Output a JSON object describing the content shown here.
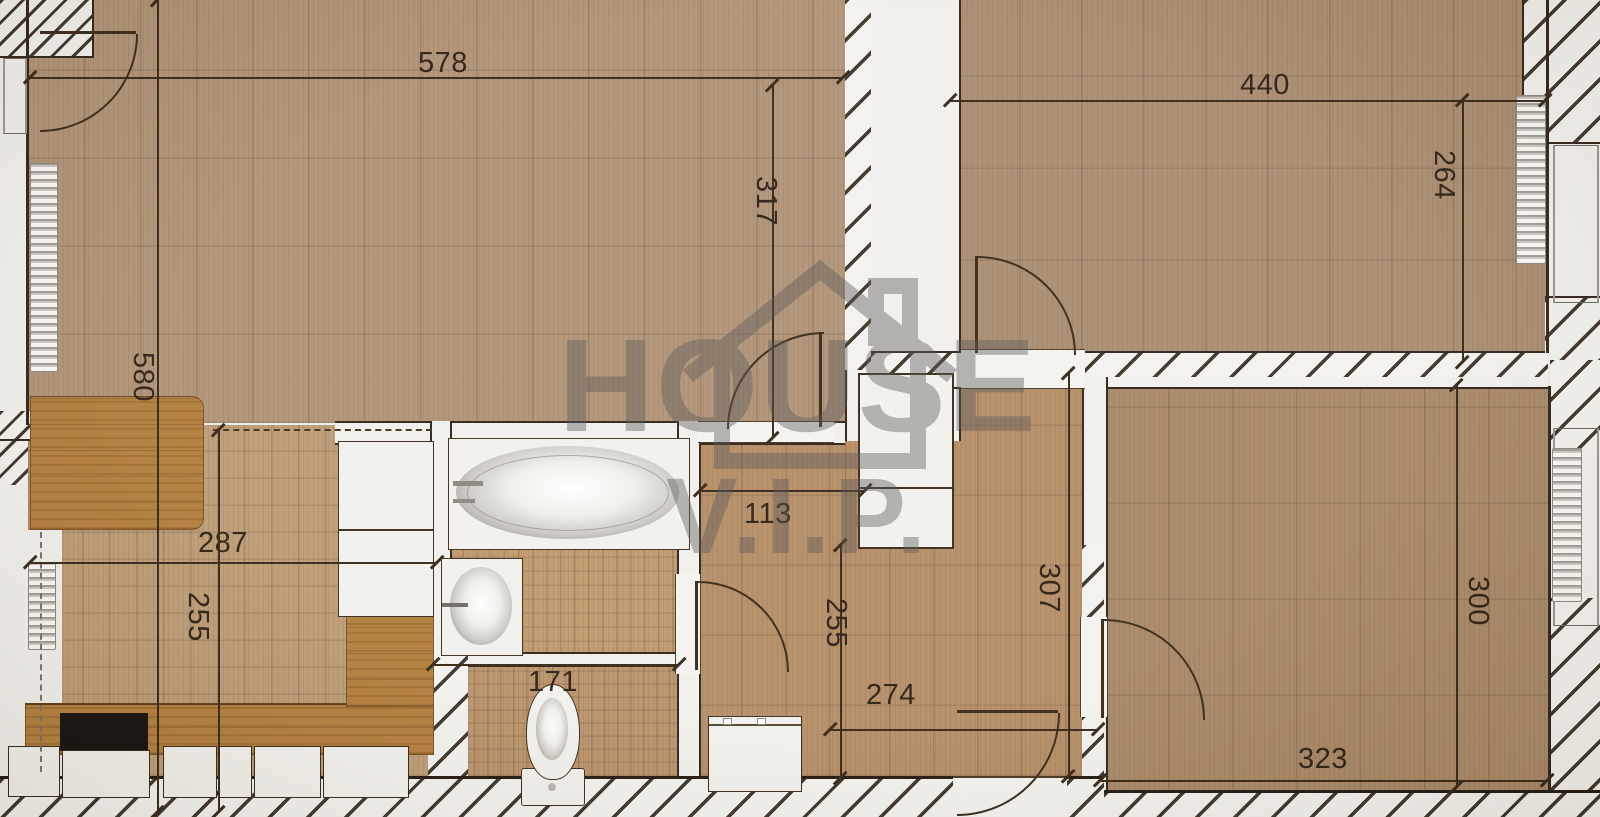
{
  "watermark": {
    "title": "HOUSE",
    "subtitle": "V.I.P."
  },
  "dimensions": [
    {
      "name": "dim-578",
      "value": "578",
      "orient": "h",
      "x": 30,
      "y": 77,
      "len": 813,
      "lx": 418,
      "ly": 49
    },
    {
      "name": "dim-580",
      "value": "580",
      "orient": "v",
      "x": 157,
      "y": 0,
      "len": 812,
      "lx": 157,
      "ly": 352
    },
    {
      "name": "dim-317",
      "value": "317",
      "orient": "v",
      "x": 772,
      "y": 85,
      "len": 353,
      "lx": 780,
      "ly": 176
    },
    {
      "name": "dim-440",
      "value": "440",
      "orient": "h",
      "x": 950,
      "y": 100,
      "len": 595,
      "lx": 1240,
      "ly": 71
    },
    {
      "name": "dim-264",
      "value": "264",
      "orient": "v",
      "x": 1462,
      "y": 100,
      "len": 262,
      "lx": 1458,
      "ly": 150
    },
    {
      "name": "dim-287",
      "value": "287",
      "orient": "h",
      "x": 30,
      "y": 562,
      "len": 407,
      "lx": 198,
      "ly": 529
    },
    {
      "name": "dim-255-left",
      "value": "255",
      "orient": "v",
      "x": 218,
      "y": 430,
      "len": 382,
      "lx": 212,
      "ly": 592
    },
    {
      "name": "dim-113",
      "value": "113",
      "orient": "h",
      "x": 700,
      "y": 490,
      "len": 165,
      "lx": 744,
      "ly": 500
    },
    {
      "name": "dim-255-hall",
      "value": "255",
      "orient": "v",
      "x": 840,
      "y": 545,
      "len": 233,
      "lx": 850,
      "ly": 598
    },
    {
      "name": "dim-307",
      "value": "307",
      "orient": "v",
      "x": 1068,
      "y": 373,
      "len": 403,
      "lx": 1063,
      "ly": 563
    },
    {
      "name": "dim-274",
      "value": "274",
      "orient": "h",
      "x": 830,
      "y": 729,
      "len": 268,
      "lx": 866,
      "ly": 681
    },
    {
      "name": "dim-171",
      "value": "171",
      "orient": "h",
      "x": 433,
      "y": 664,
      "len": 246,
      "lx": 528,
      "ly": 668
    },
    {
      "name": "dim-300",
      "value": "300",
      "orient": "v",
      "x": 1456,
      "y": 385,
      "len": 402,
      "lx": 1492,
      "ly": 576
    },
    {
      "name": "dim-323",
      "value": "323",
      "orient": "h",
      "x": 1100,
      "y": 780,
      "len": 447,
      "lx": 1298,
      "ly": 745
    }
  ],
  "palette": {
    "wall_line": "#32241a",
    "dim_text": "#2e2115",
    "wood_living": "#b19478",
    "wood_bedroom_top": "#ab8e72",
    "wood_hallway": "#b68f68",
    "wood_bedroom_bottom": "#a98969",
    "wood_kitchen": "#bd9d77",
    "wood_bath": "#c29a6e",
    "counter_wood": "#b27f3e",
    "wall_fill": "#f1f0ec",
    "cooktop": "#161210",
    "watermark_gray": "#555555"
  },
  "fixtures": [
    "bathtub",
    "sink",
    "toilet",
    "washing-machine",
    "wardrobe",
    "closet",
    "kitchen-counter",
    "cooktop",
    "kitchen-cabinets",
    "table",
    "radiator"
  ]
}
